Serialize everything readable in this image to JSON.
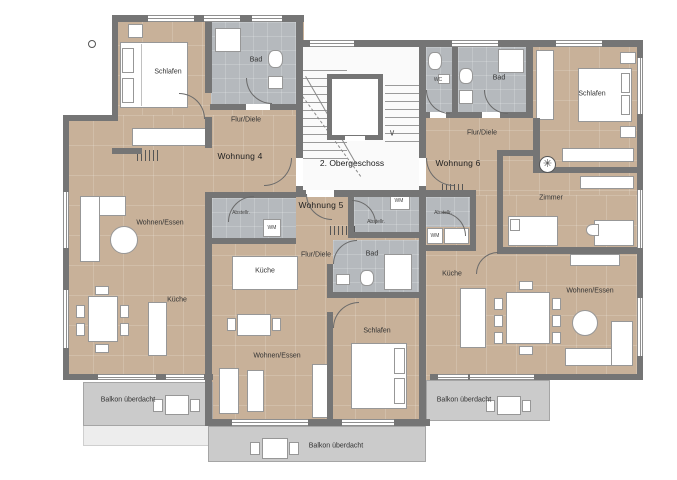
{
  "plan": {
    "floor_label": "2. Obergeschoss"
  },
  "apartments": {
    "w4": {
      "name": "Wohnung 4",
      "rooms": {
        "schlafen": "Schlafen",
        "bad": "Bad",
        "flur": "Flur/Diele",
        "wohnen_essen": "Wohnen/Essen",
        "kueche": "Küche",
        "abstell": "Abstellr.",
        "wm": "WM"
      }
    },
    "w5": {
      "name": "Wohnung 5",
      "rooms": {
        "abstell": "Abstellr.",
        "wm": "WM",
        "flur": "Flur/Diele",
        "bad": "Bad",
        "kueche": "Küche",
        "wohnen_essen": "Wohnen/Essen",
        "schlafen": "Schlafen"
      }
    },
    "w6": {
      "name": "Wohnung 6",
      "rooms": {
        "wc": "WC",
        "bad": "Bad",
        "schlafen": "Schlafen",
        "flur": "Flur/Diele",
        "zimmer": "Zimmer",
        "abstell": "Abstellr.",
        "wm": "WM",
        "kueche": "Küche",
        "wohnen_essen": "Wohnen/Essen"
      }
    }
  },
  "balconies": {
    "left": "Balkon überdacht",
    "center": "Balkon überdacht",
    "right": "Balkon überdacht"
  },
  "icons": {
    "stair_direction_arrow": "∨",
    "ceiling_fan": "✳"
  },
  "colors": {
    "wood_floor": "#c8b199",
    "tile_floor": "#b5b9bd",
    "wall": "#757575",
    "balcony": "#cbcbcb",
    "stairwell": "#fafafa"
  }
}
